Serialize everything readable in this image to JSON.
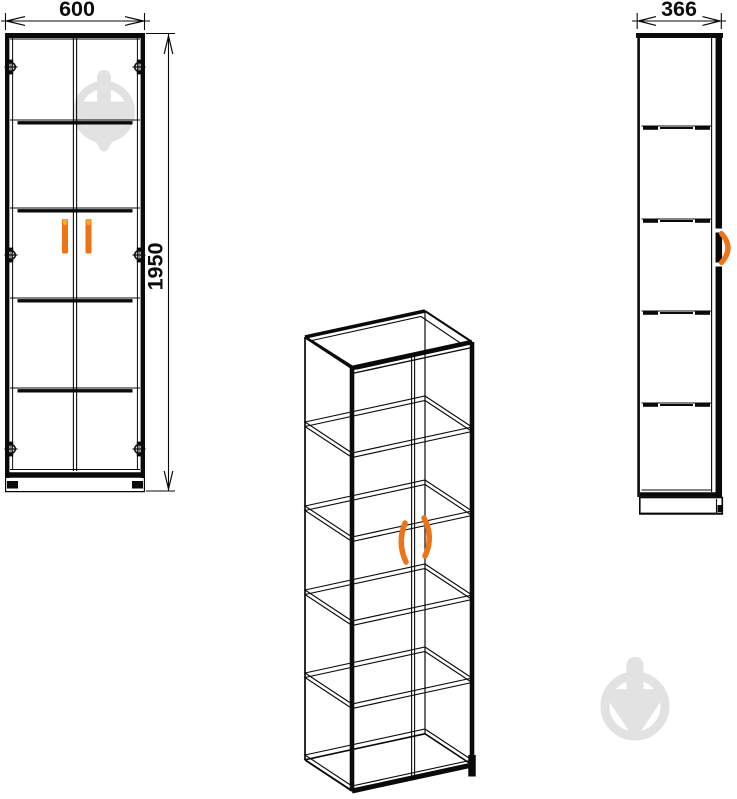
{
  "drawing": {
    "front_view": {
      "width_label": "600",
      "height_label": "1950"
    },
    "side_view": {
      "depth_label": "366"
    }
  },
  "colors": {
    "line": "#0a0a0a",
    "handle_orange": "#ee7216",
    "handle_highlight": "#f9a825",
    "watermark_gray": "#e2e2e2"
  },
  "icons": {
    "watermark": "circle-trowel-watermark",
    "hinge": "hinge-cup-circle",
    "dimension_arrow": "cad-dimension-arrow"
  }
}
